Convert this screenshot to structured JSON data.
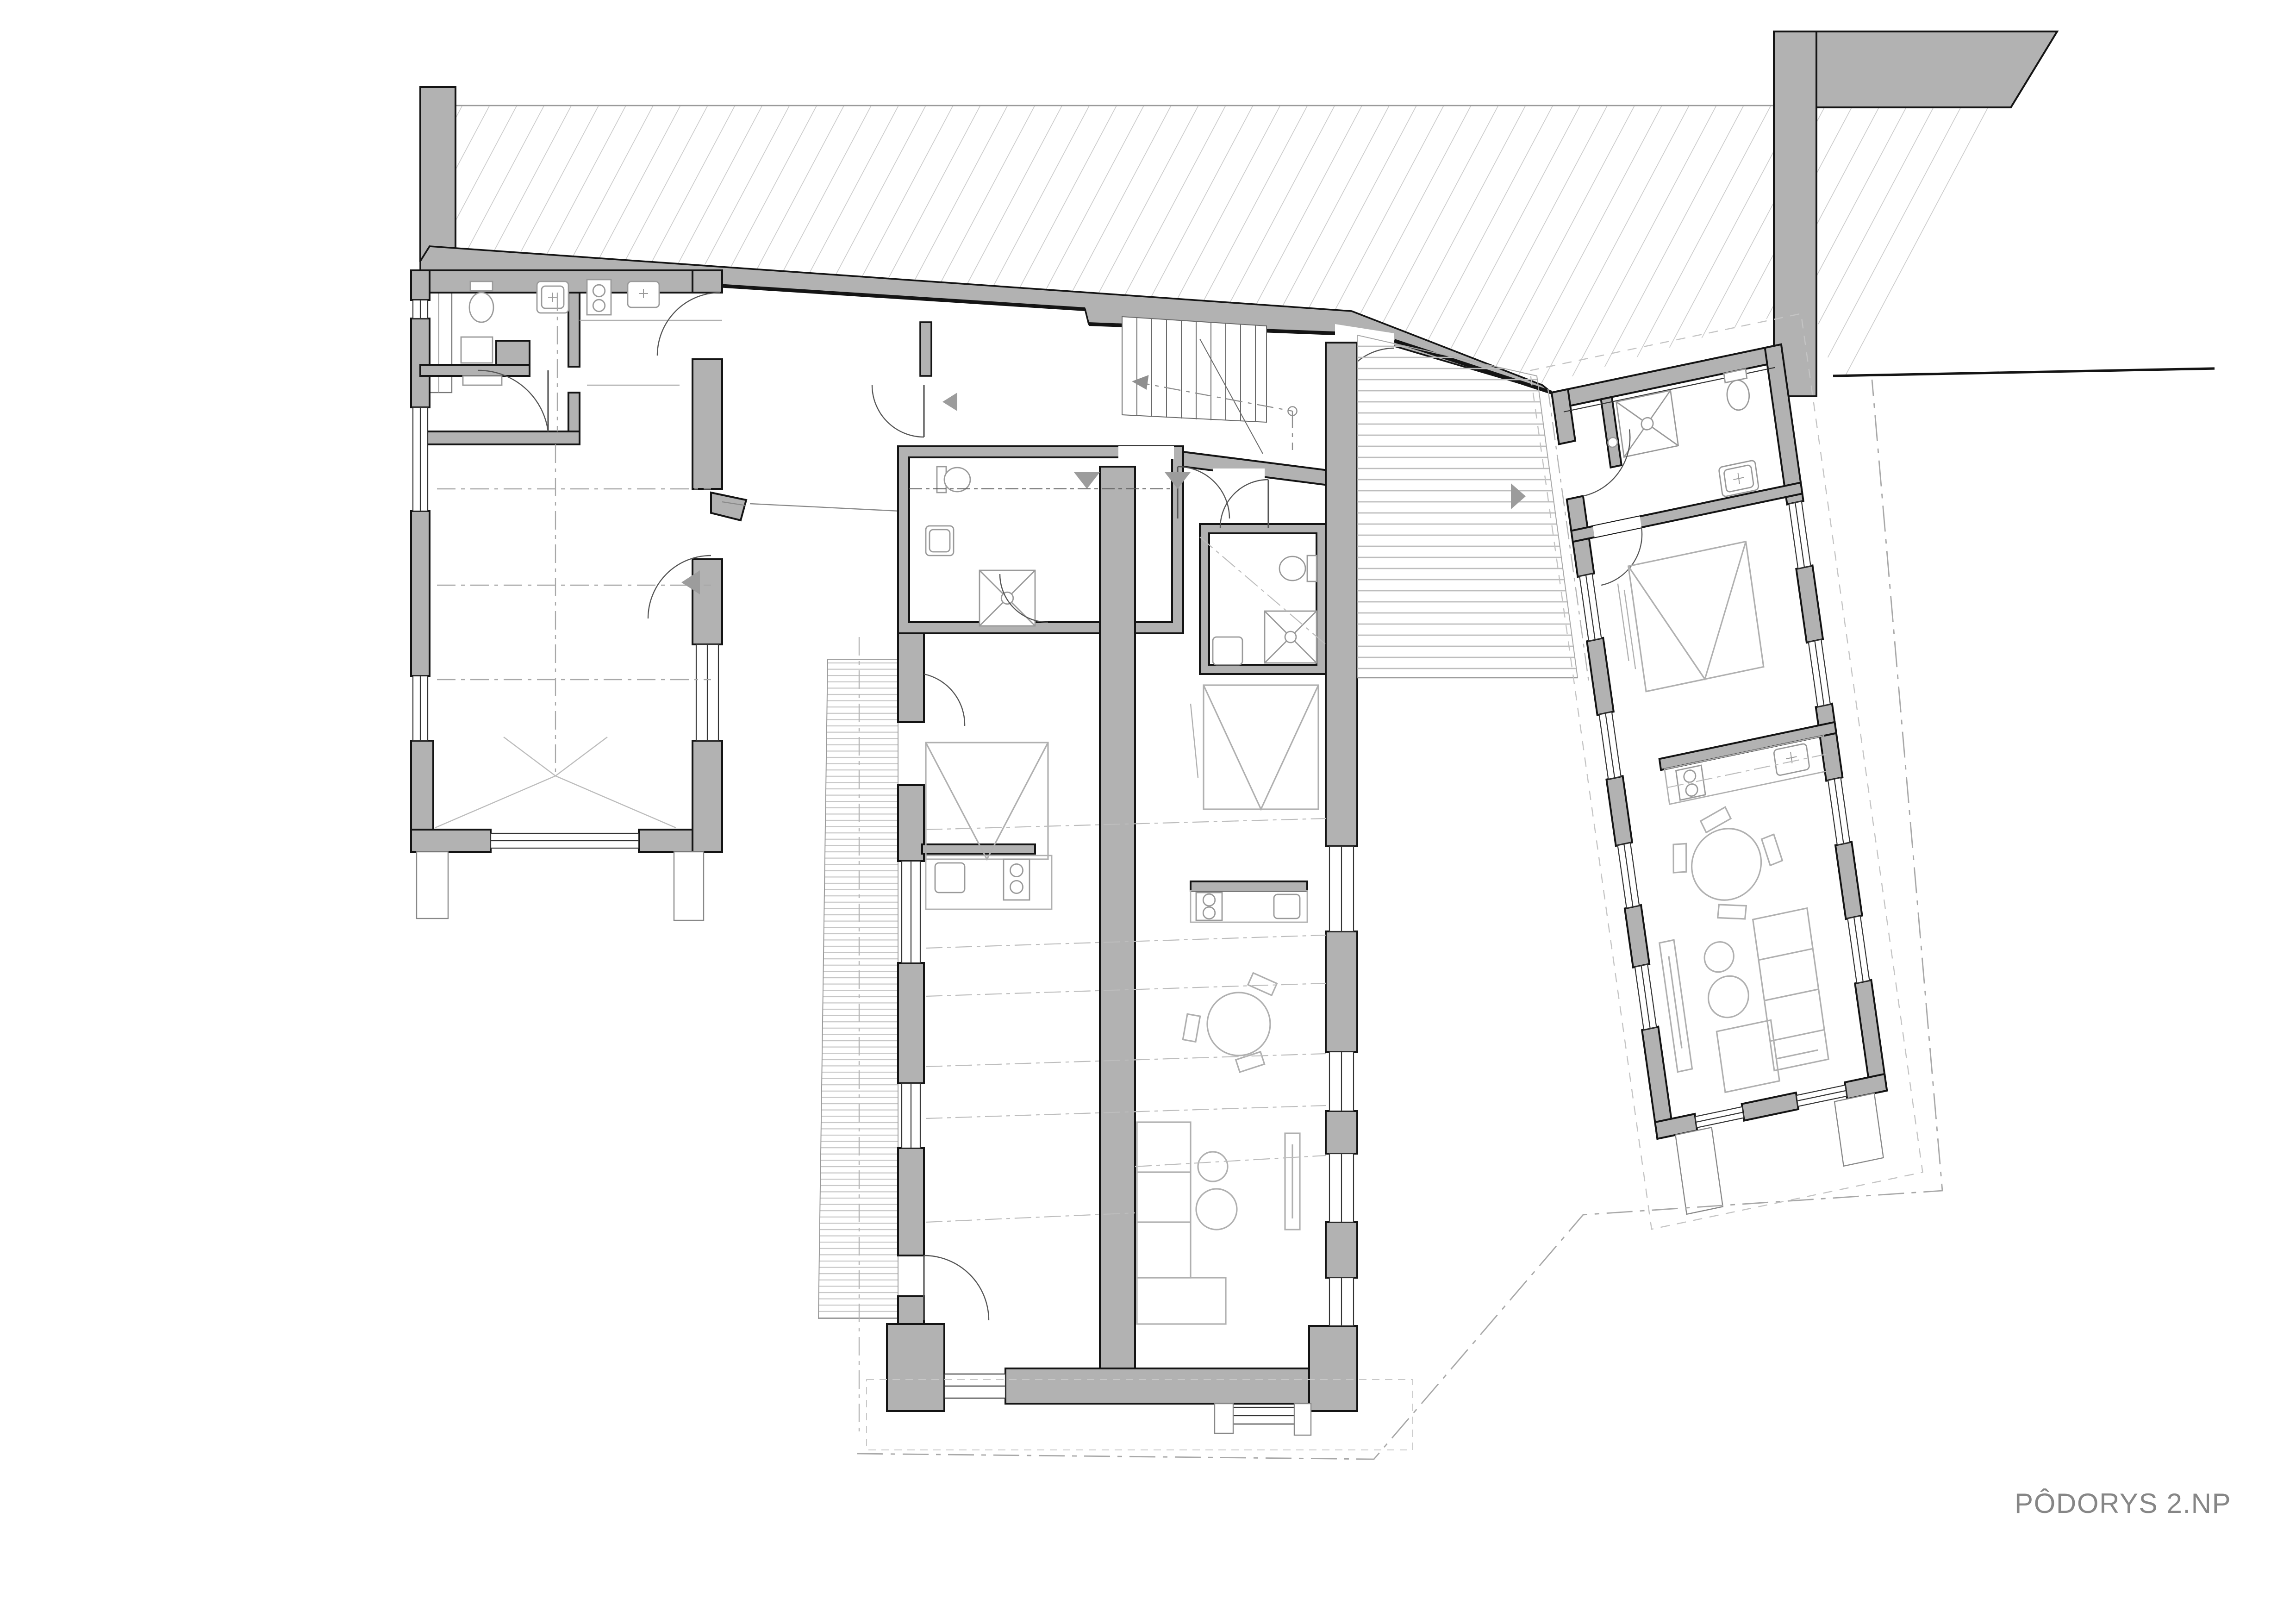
{
  "title": {
    "label": "PÔDORYS 2.NP"
  },
  "colors": {
    "wall_fill": "#b2b2b2",
    "wall_outline": "#141414",
    "hatch_line": "#c9c9c9",
    "deck_stripe": "#c6c6c6",
    "terrace_stripe": "#bdbdbd",
    "furniture_line": "#b0b0b0",
    "fixture_line": "#9a9a9a",
    "centerline": "#a8a8a8",
    "label_text": "#868686",
    "entrance_marker": "#9c9c9c"
  },
  "drawing": {
    "type": "architectural-floor-plan",
    "floor": "2.NP",
    "hatch_angle_deg": 62,
    "hatch_spacing_px": 13,
    "entrance_markers": [
      "left-wing-entrance-arrow",
      "stair-hall-entrance-arrow",
      "apartment1-entrance-arrow",
      "apartment2-entrance-arrow",
      "right-wing-entrance-arrow"
    ],
    "fixtures": [
      "toilet",
      "sink",
      "washing-machine",
      "shower",
      "cooktop",
      "bed",
      "dining-table",
      "sofa",
      "tv-board",
      "stairs"
    ]
  }
}
